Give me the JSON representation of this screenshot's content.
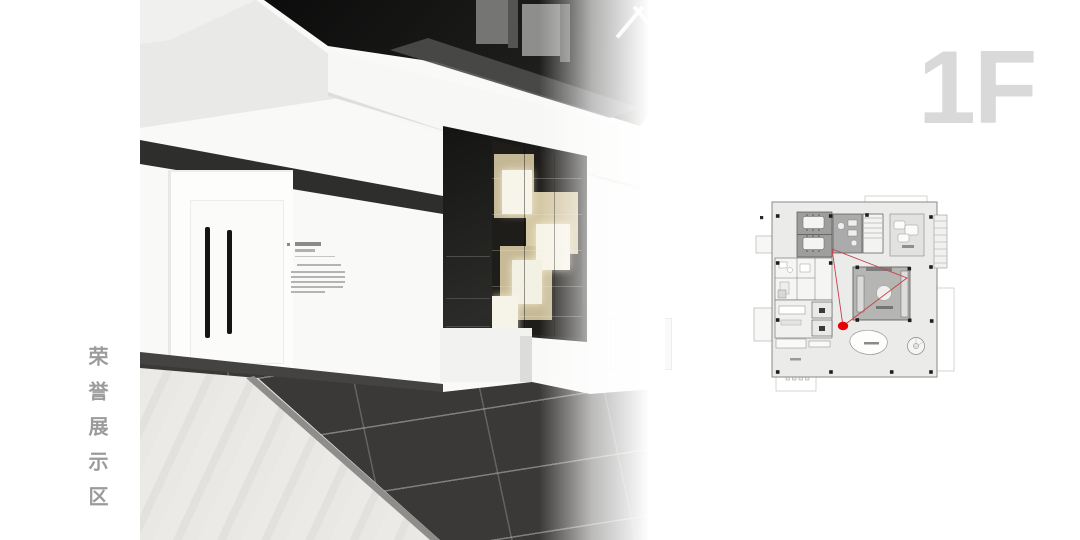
{
  "slide": {
    "background_color": "#ffffff",
    "floor_indicator": {
      "label": "1F",
      "color": "#d9d9d9"
    },
    "area_label": {
      "text": "荣誉展示区",
      "color": "#9b9b9b",
      "orientation": "vertical"
    }
  },
  "rendering": {
    "name": "honor-display-area-interior-rendering",
    "palette": {
      "ceiling_gray": "#e9e9e7",
      "black_ceiling_mass": "#141412",
      "fascia_band": "#2e2e2c",
      "shelf_beige": "#cdc09c",
      "glow_cube": "#f7f4ea",
      "dark_floor_tile": "#3b3937",
      "light_plank_floor": "#e7e5e1",
      "door_handle": "#151513"
    }
  },
  "floor_plan": {
    "name": "first-floor-plan",
    "background": "#ebebe9",
    "camera_marker": {
      "color": "#e60008",
      "x": 103,
      "y": 136
    },
    "view_cone": {
      "color": "#c84048",
      "points": "92,59 167,88 103,136"
    }
  }
}
